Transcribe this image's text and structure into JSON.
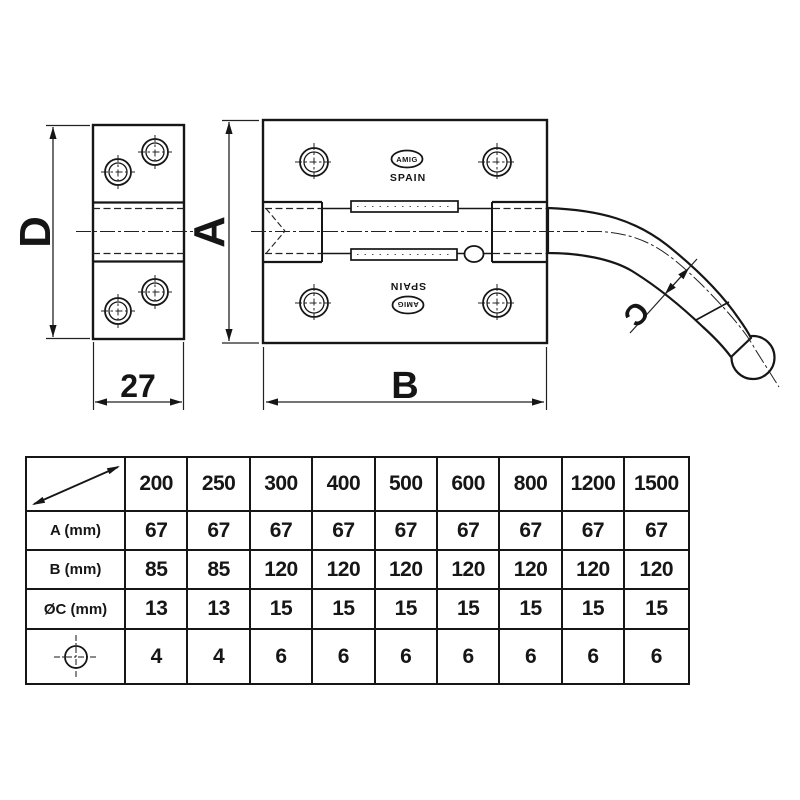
{
  "drawing": {
    "dim_labels": {
      "d": "D",
      "a": "A",
      "b": "B",
      "c": "C",
      "side_width": "27"
    },
    "brand": {
      "logo": "AMIG",
      "origin": "SPAIN"
    }
  },
  "table": {
    "sizes": [
      "200",
      "250",
      "300",
      "400",
      "500",
      "600",
      "800",
      "1200",
      "1500"
    ],
    "rows": [
      {
        "label": "A (mm)",
        "values": [
          "67",
          "67",
          "67",
          "67",
          "67",
          "67",
          "67",
          "67",
          "67"
        ]
      },
      {
        "label": "B (mm)",
        "values": [
          "85",
          "85",
          "120",
          "120",
          "120",
          "120",
          "120",
          "120",
          "120"
        ]
      },
      {
        "label": "ØC (mm)",
        "values": [
          "13",
          "13",
          "15",
          "15",
          "15",
          "15",
          "15",
          "15",
          "15"
        ]
      },
      {
        "icon": "hole-position-icon",
        "values": [
          "4",
          "4",
          "6",
          "6",
          "6",
          "6",
          "6",
          "6",
          "6"
        ]
      }
    ]
  }
}
